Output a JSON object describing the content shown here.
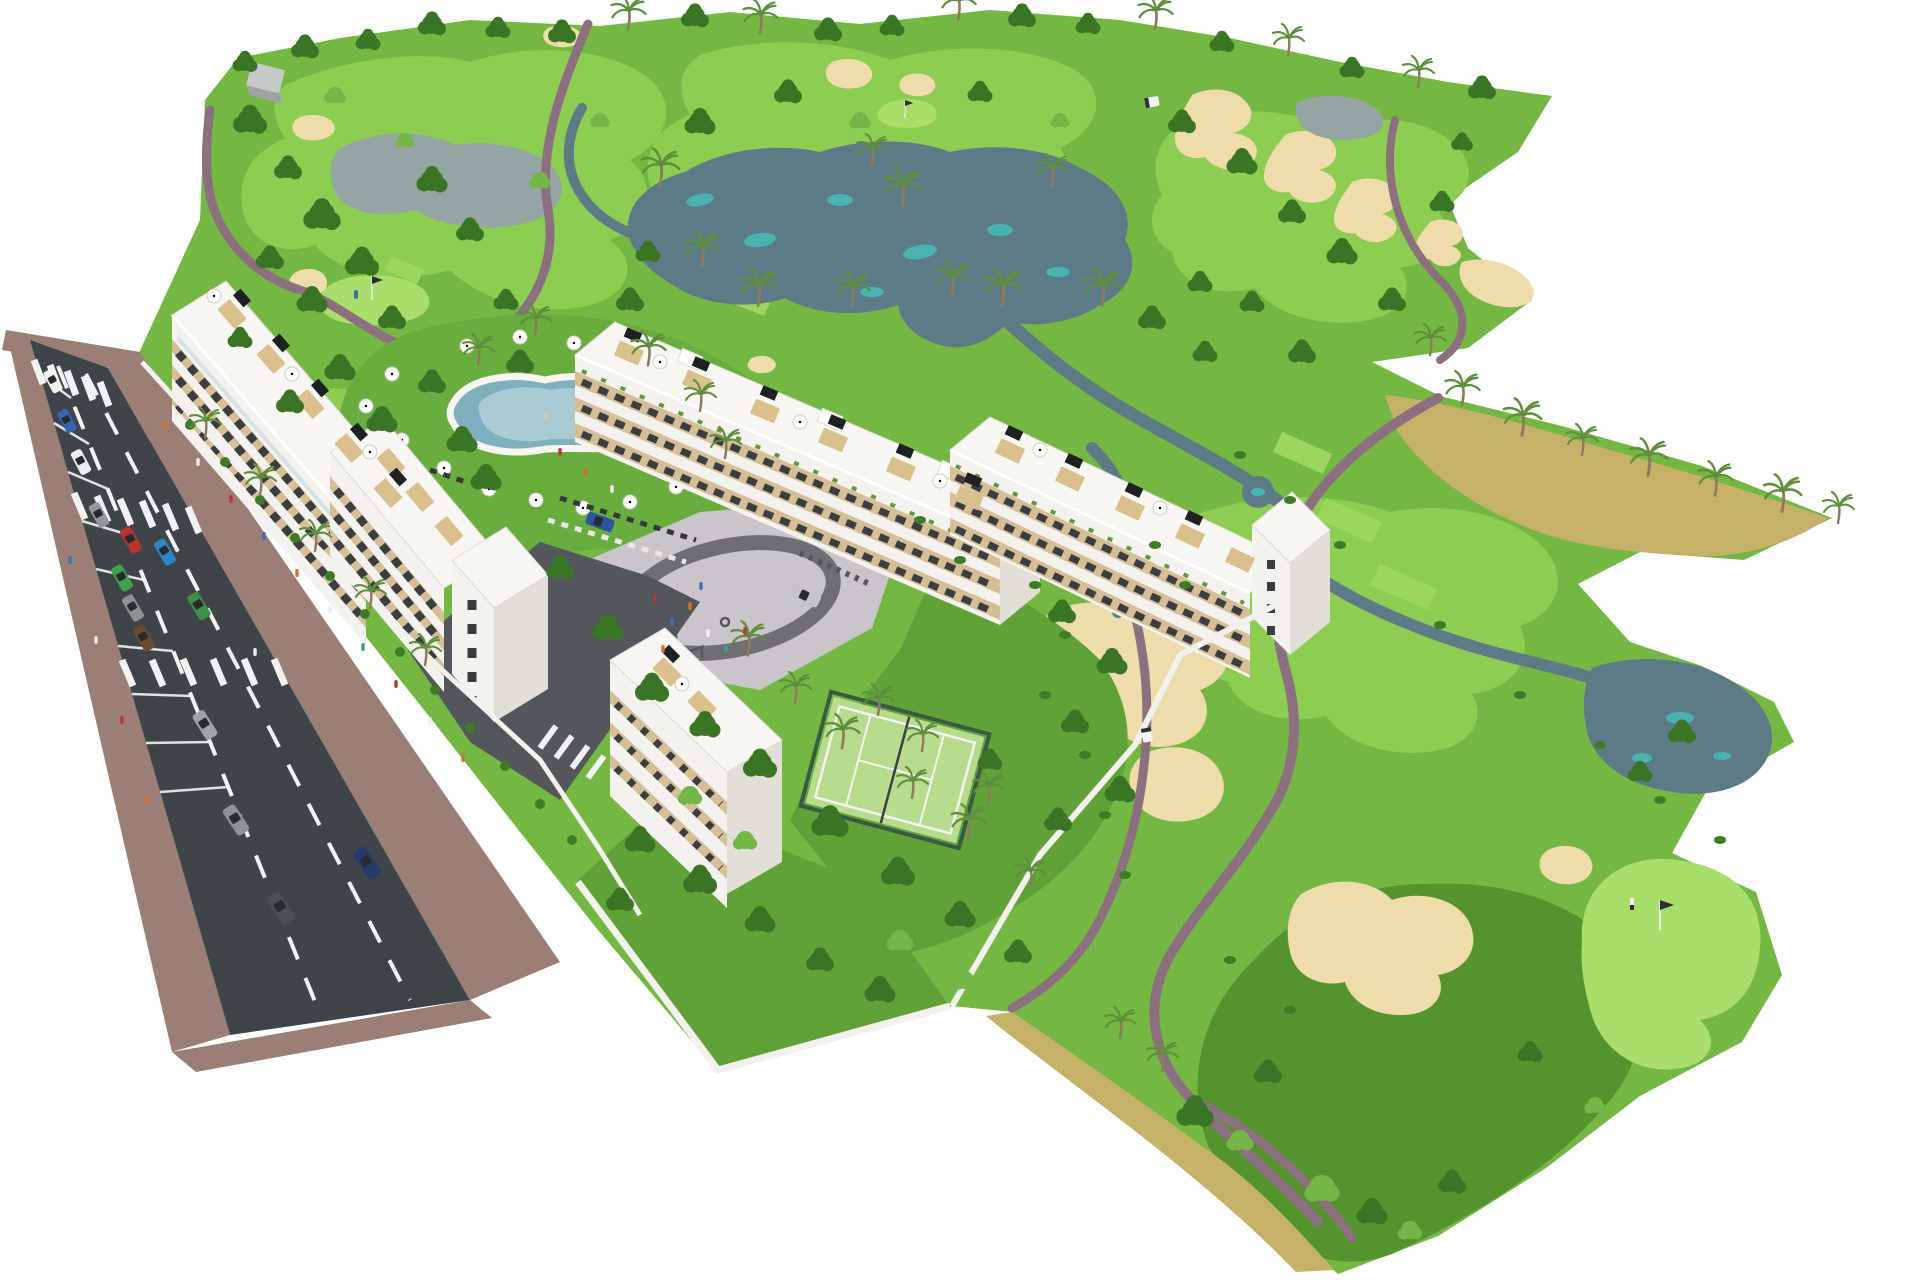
{
  "meta": {
    "description": "Aerial 3D architectural rendering of a white apartment resort complex beside a golf course with lakes, sand bunkers, cart paths, a pool, playground, padel court and a tree-lined avenue",
    "render_type": "computer generated site visualization",
    "background": "#ffffff"
  },
  "colors": {
    "fairway": "#74b843",
    "fairway_light": "#8ccd52",
    "fairway_bright": "#9bd75f",
    "green_bright": "#a8de69",
    "rough_dark": "#55932e",
    "lawn": "#68ad3d",
    "garden": "#61a238",
    "dry": "#c6b169",
    "sand": "#eedcab",
    "water": "#5d7a87",
    "water_teal": "#45bdb7",
    "water_gray": "#95a5a4",
    "path": "#8d7080",
    "road": "#3f4448",
    "drive": "#53575b",
    "sidewalk": "#9b7f77",
    "lane": "#f2f2f2",
    "wall": "#f2f1ed",
    "roof": "#f7f6f2",
    "roof_edge": "#dddbd4",
    "face": "#f3f2ee",
    "face_shade": "#e2dfd8",
    "beige": "#d6bf97",
    "window": "#3a3e41",
    "glass": "#cfe0e4",
    "balcony_green": "#5c9a3a",
    "pergola": "#d9c08c",
    "deck_black": "#1e2022",
    "parasol": "#fdfdfb",
    "plaza": "#c9c5ca",
    "ring": "#6f6e73",
    "court_green": "#b7dc8e",
    "court_fence": "#3a5a44",
    "pool_water": "#7fb0bd",
    "pool_inner": "#a9ccd4",
    "pool_deck": "#f6f5f1",
    "tree_dark": "#3a7526",
    "tree_light": "#74b647",
    "bush": "#3f7c28",
    "palm": "#5f8f3c",
    "trunk": "#8d7b5e",
    "hedge": "#3f7c28",
    "flag_dark": "#2c3033",
    "equip": "#54585c",
    "hut_top": "#c6c9ca",
    "hut_side": "#9fa3a4",
    "cart_body": "#f4f4f2",
    "skin": "#e8c49a",
    "people_orange": "#d4702c",
    "people_red": "#bf3434",
    "people_blue": "#3f6fb5",
    "people_white": "#efefef",
    "people_teal": "#3f9d8f"
  },
  "cars": {
    "parked": [
      "#f2f2f0",
      "#3565b0",
      "#eceded",
      "#909699",
      "#41a04c",
      "#8d9296",
      "#6b4a33"
    ],
    "moving": [
      "#b8322e",
      "#2e86c8",
      "#3e8f4a",
      "#9ea3a7",
      "#8d9296",
      "#4a4f53",
      "#273a6e"
    ],
    "internal": [
      "#2c53a0",
      "#c3c6c9"
    ]
  },
  "golf": {
    "greens": 3,
    "flags": 3,
    "tee_boxes": 5,
    "bunker_clusters": 13,
    "ponds": 6,
    "streams": 3,
    "golf_carts": 2,
    "golfers": 2
  },
  "road_info": {
    "crosswalks": 3,
    "internal_crosswalks": 1,
    "lane_divider_lines": 2,
    "sides_with_sidewalk": 2
  },
  "residential": {
    "buildings": [
      {
        "id": "block-a",
        "kind": "apartment slab along avenue",
        "floors": 4
      },
      {
        "id": "block-b",
        "kind": "terraced row with roof decks",
        "floors": 3
      },
      {
        "id": "block-c",
        "kind": "terraced row with corner tower",
        "floors": 3
      },
      {
        "id": "block-d",
        "kind": "south corner block",
        "floors": 4
      }
    ],
    "amenities": [
      "lagoon-pool",
      "sun-loungers",
      "parasols",
      "playground",
      "outdoor-gym",
      "padel-court",
      "putting-green",
      "private-gardens"
    ]
  }
}
